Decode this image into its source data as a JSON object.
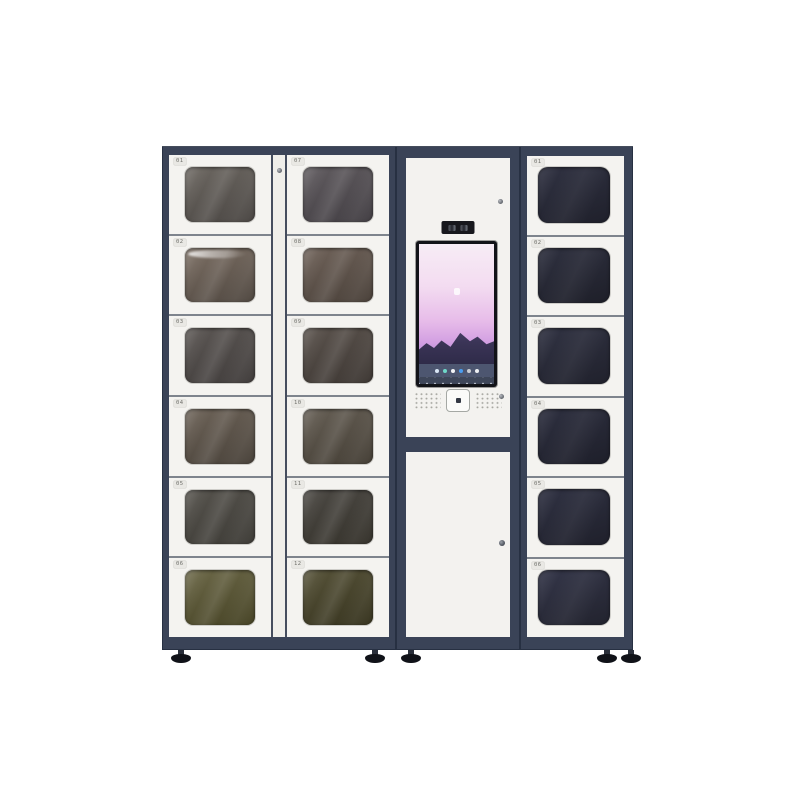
{
  "colors": {
    "background": "#ffffff",
    "frame": "#3a4357",
    "frame_edge": "#273042",
    "door": "#f4f3f0",
    "door_gap": "#7e848d",
    "divider_panel": "#efeeea",
    "divider_line": "#454d5e",
    "label_text": "#6f6f6a",
    "label_plate": "#e9e8e4",
    "kiosk_panel": "#f3f2ef",
    "screen_bezel": "#121318",
    "taskbar": "#4d5670",
    "navbar": "#3e4659",
    "scanner_border": "#a5a8a4",
    "speaker_dot": "#a8a8a2",
    "foot": "#101218",
    "foot_stem": "#2a2f3a"
  },
  "left_cabinet": {
    "column_a": [
      {
        "label": "01",
        "glass": {
          "a": "#6d6862",
          "b": "#4a4643"
        }
      },
      {
        "label": "02",
        "glass": {
          "a": "#7d7065",
          "b": "#4f4740"
        }
      },
      {
        "label": "03",
        "glass": {
          "a": "#5c5754",
          "b": "#403c3b"
        }
      },
      {
        "label": "04",
        "glass": {
          "a": "#6e6459",
          "b": "#484139"
        }
      },
      {
        "label": "05",
        "glass": {
          "a": "#56534d",
          "b": "#3d3b36"
        }
      },
      {
        "label": "06",
        "glass": {
          "a": "#6d6949",
          "b": "#454224"
        }
      }
    ],
    "column_b": [
      {
        "label": "07",
        "glass": {
          "a": "#615c60",
          "b": "#423e43"
        }
      },
      {
        "label": "08",
        "glass": {
          "a": "#70635a",
          "b": "#494039"
        }
      },
      {
        "label": "09",
        "glass": {
          "a": "#5b534d",
          "b": "#3d3733"
        }
      },
      {
        "label": "10",
        "glass": {
          "a": "#665f55",
          "b": "#443e35"
        }
      },
      {
        "label": "11",
        "glass": {
          "a": "#4c4944",
          "b": "#35322b"
        }
      },
      {
        "label": "12",
        "glass": {
          "a": "#575339",
          "b": "#37341f"
        }
      }
    ]
  },
  "right_cabinet": {
    "column": [
      {
        "label": "01",
        "glass": {
          "a": "#303242",
          "b": "#1f202b"
        }
      },
      {
        "label": "02",
        "glass": {
          "a": "#2f3140",
          "b": "#1e1f29"
        }
      },
      {
        "label": "03",
        "glass": {
          "a": "#313343",
          "b": "#20212c"
        }
      },
      {
        "label": "04",
        "glass": {
          "a": "#2e3040",
          "b": "#1e1f2a"
        }
      },
      {
        "label": "05",
        "glass": {
          "a": "#303243",
          "b": "#1f202b"
        }
      },
      {
        "label": "06",
        "glass": {
          "a": "#343649",
          "b": "#22232e"
        }
      }
    ]
  },
  "kiosk": {
    "screen": {
      "sky": {
        "angle": 180,
        "stops": [
          [
            "#f7ecf5",
            "0%"
          ],
          [
            "#f3dcf1",
            "30%"
          ],
          [
            "#e7bce9",
            "55%"
          ],
          [
            "#d3a0e2",
            "70%"
          ],
          [
            "#b88cd8",
            "80%"
          ],
          [
            "#a685cb",
            "84%"
          ]
        ]
      },
      "mountains": {
        "angle": 180,
        "stops": [
          [
            "#4b4268",
            "0%"
          ],
          [
            "#3a3456",
            "45%"
          ],
          [
            "#2f2b49",
            "100%"
          ]
        ]
      },
      "logo": "#ffffff",
      "taskbar_icons": [
        "#d9e6f5",
        "#6fd8c9",
        "#f2f3f5",
        "#4a9df0",
        "#c9ccd2",
        "#eceef2"
      ]
    }
  }
}
